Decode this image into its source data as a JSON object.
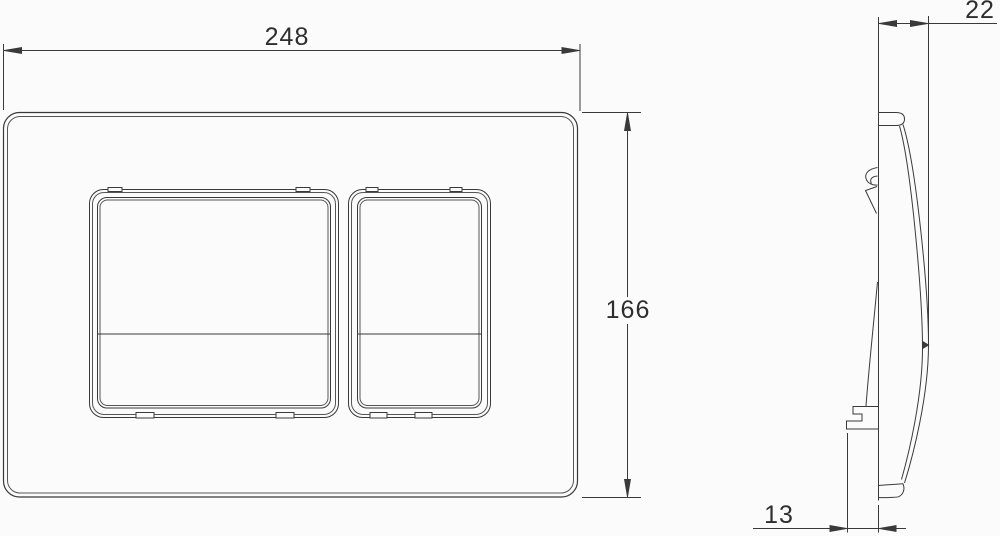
{
  "drawing": {
    "dimensions": {
      "front_width": "248",
      "front_height": "166",
      "side_depth": "22",
      "side_bottom_offset": "13"
    }
  },
  "colors": {
    "line": "#3a3a3a",
    "line_secondary": "#555555",
    "text": "#2e2e2e",
    "background": "#fbfbfb"
  }
}
